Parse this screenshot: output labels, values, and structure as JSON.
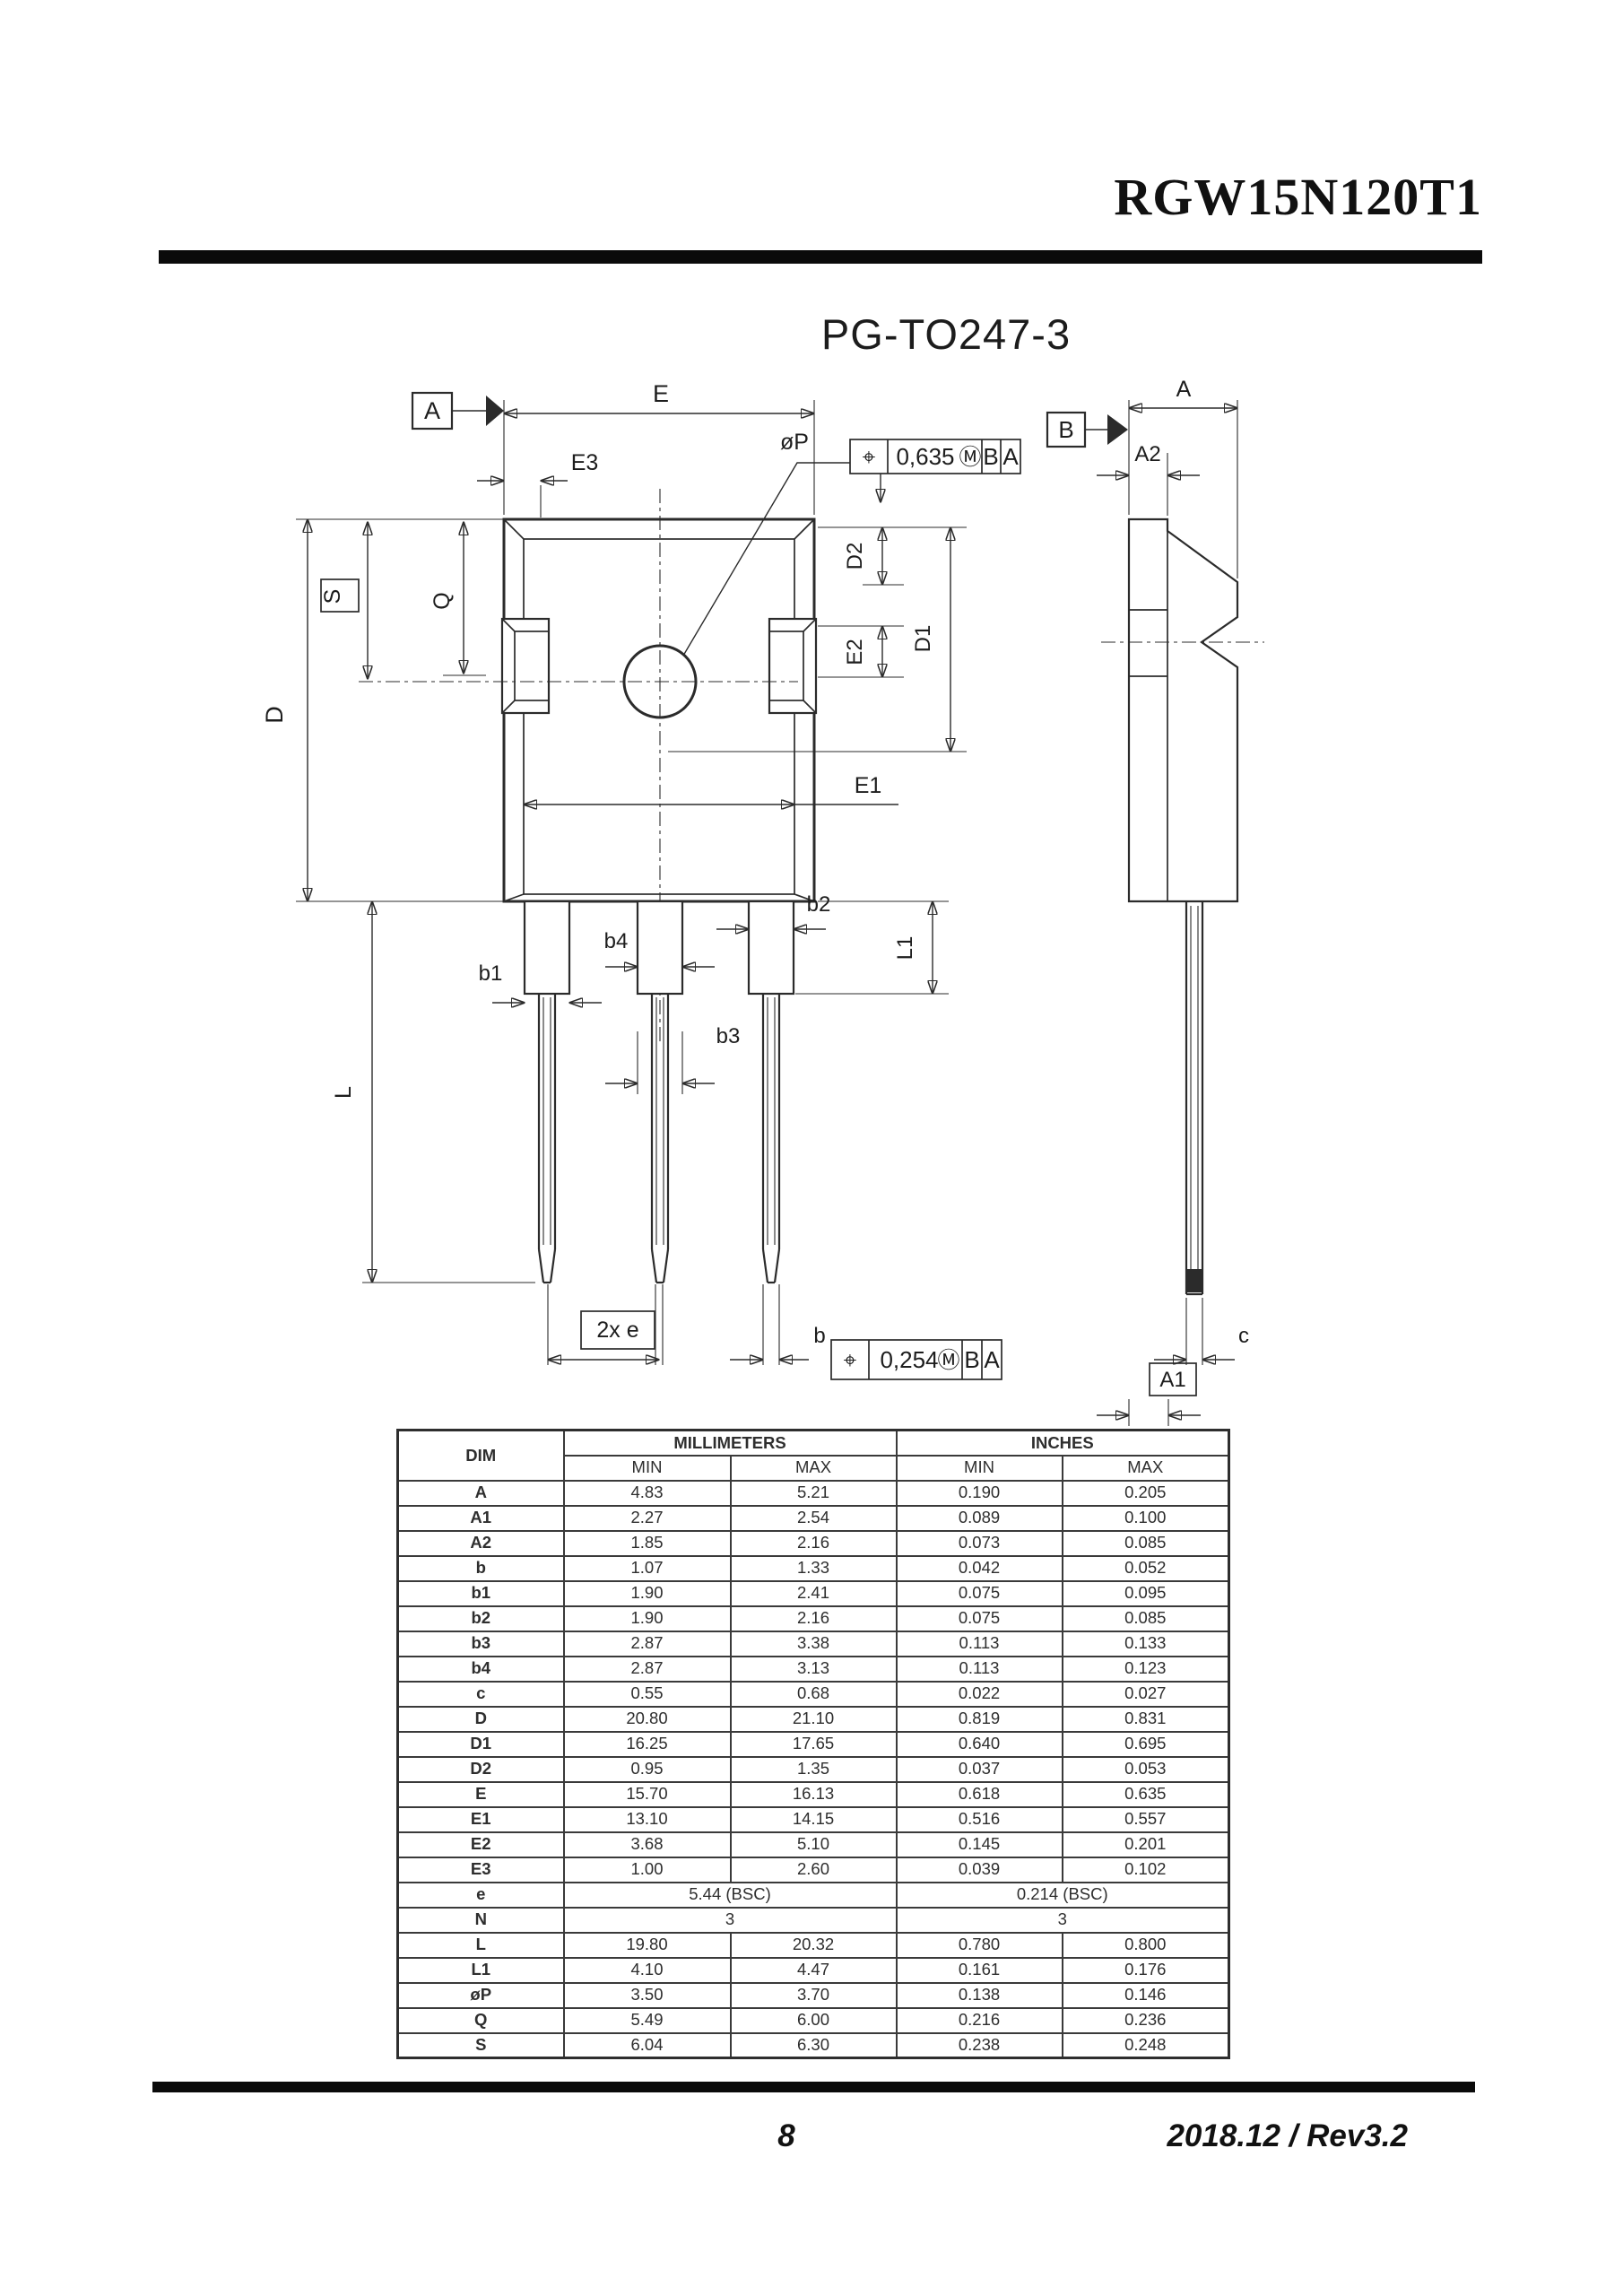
{
  "header": {
    "part_number": "RGW15N120T1"
  },
  "page_title": "PG-TO247-3",
  "colors": {
    "ink": "#1d1d1d",
    "line": "#2b2b2b",
    "rule": "#0a0a0a"
  },
  "drawing": {
    "datums": {
      "a": "A",
      "b": "B",
      "a1": "A1"
    },
    "dims": {
      "E": "E",
      "E3": "E3",
      "oP": "øP",
      "S": "S",
      "Q": "Q",
      "D": "D",
      "D1": "D1",
      "D2": "D2",
      "E1": "E1",
      "E2": "E2",
      "b": "b",
      "b1": "b1",
      "b2": "b2",
      "b3": "b3",
      "b4": "b4",
      "L": "L",
      "L1": "L1",
      "c": "c",
      "A": "A",
      "A2": "A2",
      "e2x": "2x e"
    },
    "fcf_top": {
      "symbol": "⌖",
      "value": "0,635",
      "modifier": "Ⓜ",
      "datum_b": "B",
      "datum_a": "A"
    },
    "fcf_bottom": {
      "symbol": "⌖",
      "value": "0,254",
      "modifier": "Ⓜ",
      "datum_b": "B",
      "datum_a": "A"
    }
  },
  "table": {
    "dim_header": "DIM",
    "group_headers": [
      "MILLIMETERS",
      "INCHES"
    ],
    "sub_headers": [
      "MIN",
      "MAX",
      "MIN",
      "MAX"
    ],
    "rows": [
      {
        "dim": "A",
        "mm_min": "4.83",
        "mm_max": "5.21",
        "in_min": "0.190",
        "in_max": "0.205"
      },
      {
        "dim": "A1",
        "mm_min": "2.27",
        "mm_max": "2.54",
        "in_min": "0.089",
        "in_max": "0.100"
      },
      {
        "dim": "A2",
        "mm_min": "1.85",
        "mm_max": "2.16",
        "in_min": "0.073",
        "in_max": "0.085"
      },
      {
        "dim": "b",
        "mm_min": "1.07",
        "mm_max": "1.33",
        "in_min": "0.042",
        "in_max": "0.052"
      },
      {
        "dim": "b1",
        "mm_min": "1.90",
        "mm_max": "2.41",
        "in_min": "0.075",
        "in_max": "0.095"
      },
      {
        "dim": "b2",
        "mm_min": "1.90",
        "mm_max": "2.16",
        "in_min": "0.075",
        "in_max": "0.085"
      },
      {
        "dim": "b3",
        "mm_min": "2.87",
        "mm_max": "3.38",
        "in_min": "0.113",
        "in_max": "0.133"
      },
      {
        "dim": "b4",
        "mm_min": "2.87",
        "mm_max": "3.13",
        "in_min": "0.113",
        "in_max": "0.123"
      },
      {
        "dim": "c",
        "mm_min": "0.55",
        "mm_max": "0.68",
        "in_min": "0.022",
        "in_max": "0.027"
      },
      {
        "dim": "D",
        "mm_min": "20.80",
        "mm_max": "21.10",
        "in_min": "0.819",
        "in_max": "0.831"
      },
      {
        "dim": "D1",
        "mm_min": "16.25",
        "mm_max": "17.65",
        "in_min": "0.640",
        "in_max": "0.695"
      },
      {
        "dim": "D2",
        "mm_min": "0.95",
        "mm_max": "1.35",
        "in_min": "0.037",
        "in_max": "0.053"
      },
      {
        "dim": "E",
        "mm_min": "15.70",
        "mm_max": "16.13",
        "in_min": "0.618",
        "in_max": "0.635"
      },
      {
        "dim": "E1",
        "mm_min": "13.10",
        "mm_max": "14.15",
        "in_min": "0.516",
        "in_max": "0.557"
      },
      {
        "dim": "E2",
        "mm_min": "3.68",
        "mm_max": "5.10",
        "in_min": "0.145",
        "in_max": "0.201"
      },
      {
        "dim": "E3",
        "mm_min": "1.00",
        "mm_max": "2.60",
        "in_min": "0.039",
        "in_max": "0.102"
      },
      {
        "dim": "e",
        "mm_span": "5.44 (BSC)",
        "in_span": "0.214 (BSC)"
      },
      {
        "dim": "N",
        "mm_span": "3",
        "in_span": "3"
      },
      {
        "dim": "L",
        "mm_min": "19.80",
        "mm_max": "20.32",
        "in_min": "0.780",
        "in_max": "0.800"
      },
      {
        "dim": "L1",
        "mm_min": "4.10",
        "mm_max": "4.47",
        "in_min": "0.161",
        "in_max": "0.176"
      },
      {
        "dim": "øP",
        "mm_min": "3.50",
        "mm_max": "3.70",
        "in_min": "0.138",
        "in_max": "0.146"
      },
      {
        "dim": "Q",
        "mm_min": "5.49",
        "mm_max": "6.00",
        "in_min": "0.216",
        "in_max": "0.236"
      },
      {
        "dim": "S",
        "mm_min": "6.04",
        "mm_max": "6.30",
        "in_min": "0.238",
        "in_max": "0.248"
      }
    ]
  },
  "footer": {
    "page_number": "8",
    "revision": "2018.12 / Rev3.2"
  }
}
